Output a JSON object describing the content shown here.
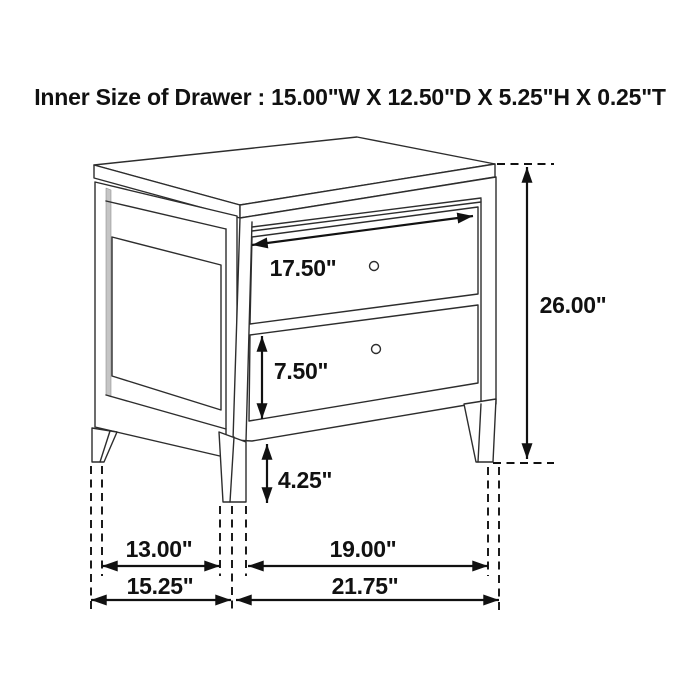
{
  "title": "Inner Size of Drawer : 15.00\"W X 12.50\"D X 5.25\"H X 0.25\"T",
  "dimension_labels": {
    "top_drawer_width": "17.50\"",
    "bottom_drawer_front_height": "7.50\"",
    "overall_height": "26.00\"",
    "leg_height": "4.25\"",
    "side_leg_spacing_depth": "13.00\"",
    "overall_depth": "15.25\"",
    "front_leg_spacing_width": "19.00\"",
    "overall_width": "21.75\""
  },
  "colors": {
    "background": "#ffffff",
    "line_art": "#2d2d2d",
    "dimension_ink": "#111111",
    "panel_shadow": "#c5c5c5"
  }
}
